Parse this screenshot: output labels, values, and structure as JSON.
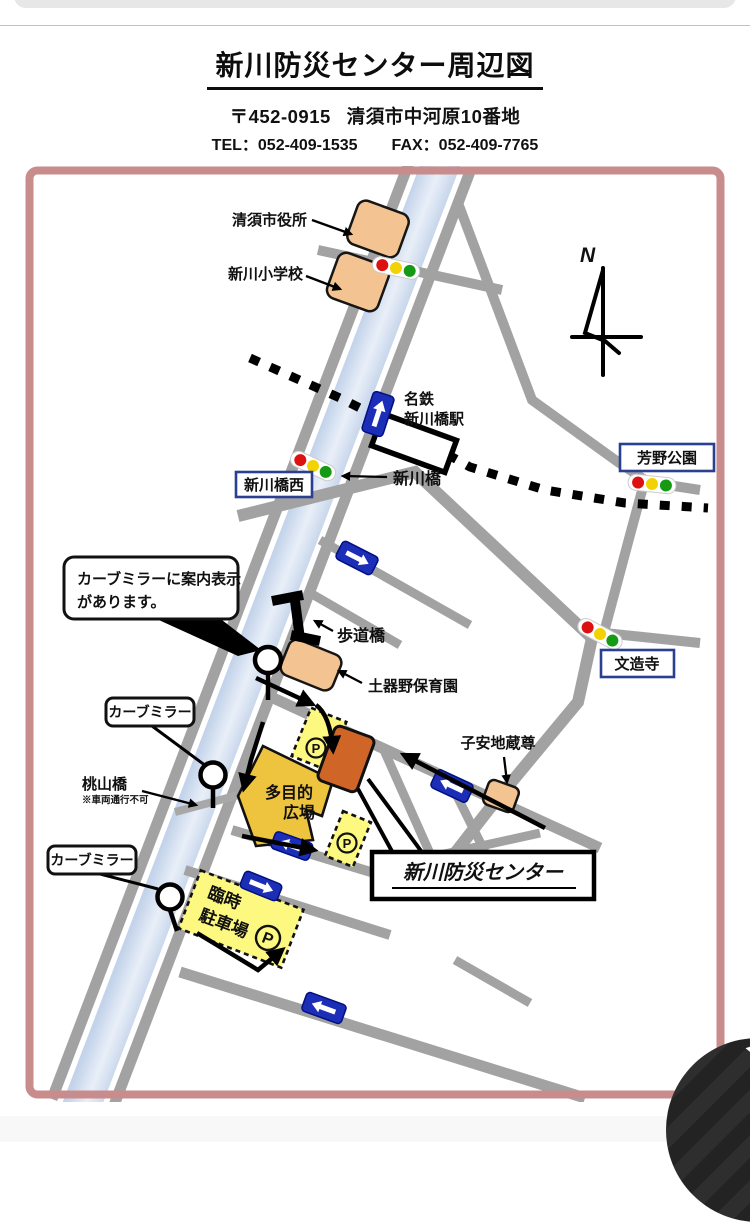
{
  "header": {
    "title": "新川防災センター周辺図",
    "postal_code": "〒452-0915",
    "address": "清須市中河原10番地",
    "tel": "TEL：052-409-1535",
    "fax": "FAX：052-409-7765"
  },
  "map": {
    "compass": "N",
    "labels": {
      "city_hall": "清須市役所",
      "elementary_school": "新川小学校",
      "station_line1": "名鉄",
      "station_line2": "新川橋駅",
      "shinkawa_bridge": "新川橋",
      "bridge_west_intersection": "新川橋西",
      "yoshino_park": "芳野公園",
      "bunzoji_temple": "文造寺",
      "pedestrian_bridge": "歩道橋",
      "nursery_school": "土器野保育園",
      "koyasu_jizo": "子安地蔵尊",
      "momoyama_bridge": "桃山橋",
      "momoyama_note": "※車両通行不可",
      "curve_mirror": "カーブミラー",
      "mirror_callout_line1": "カーブミラーに案内表示",
      "mirror_callout_line2": "があります。",
      "plaza_line1": "多目的",
      "plaza_line2": "広場",
      "temp_parking_line1": "臨時",
      "temp_parking_line2": "駐車場",
      "parking_symbol": "P",
      "center_name": "新川防災センター"
    },
    "colors": {
      "frame": "#c98c8c",
      "road": "#a2a2a2",
      "river": "#ccdaee",
      "building": "#f3c491",
      "center_building": "#cf6627",
      "plaza": "#eec33d",
      "parking": "#fcf880",
      "one_way_sign": "#1c2eb8",
      "label_border": "#2a3f8f",
      "railway": "#000000"
    }
  }
}
